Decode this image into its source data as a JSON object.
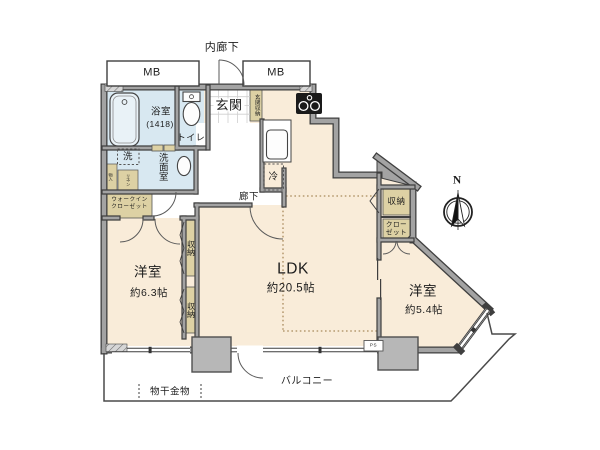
{
  "colors": {
    "floor_cream": "#f9ecd9",
    "wet_blue": "#d8e8f1",
    "storage_tan": "#ddd1a4",
    "wall_gray": "#a3a3a3",
    "wall_edge": "#3f3f3f",
    "pillar_gray": "#b7b7b7",
    "dotted_zone": "#a98a5c"
  },
  "rooms": [
    {
      "name": "LDK",
      "size": "約20.5帖"
    },
    {
      "name": "洋室",
      "size": "約6.3帖"
    },
    {
      "name": "洋室",
      "size": "約5.4帖"
    },
    {
      "name": "浴室",
      "size": "1418"
    }
  ],
  "labels": {
    "inner_corridor": "内廊下",
    "mb_left": "MB",
    "mb_right": "MB",
    "entrance": "玄関",
    "entrance_storage": "玄関収納",
    "bathroom": "浴室",
    "bathroom_size": "(1418)",
    "toilet": "トイレ",
    "washer": "洗",
    "washroom": "洗面室",
    "storage_small_left": "物入",
    "storage_small_right": "リネン",
    "wic_line1": "ウォークイン",
    "wic_line2": "クローゼット",
    "hallway": "廊下",
    "fridge": "冷",
    "storage_mid_upper": "収納",
    "storage_mid_lower": "収納",
    "storage_right": "収納",
    "closet_line1": "クロー",
    "closet_line2": "ゼット",
    "bedroom1": "洋室",
    "bedroom1_size": "約6.3帖",
    "ldk": "LDK",
    "ldk_size": "約20.5帖",
    "bedroom2": "洋室",
    "bedroom2_size": "約5.4帖",
    "balcony": "バルコニー",
    "drying_fixture": "物干金物",
    "pipe_space": "PS",
    "north": "N"
  }
}
